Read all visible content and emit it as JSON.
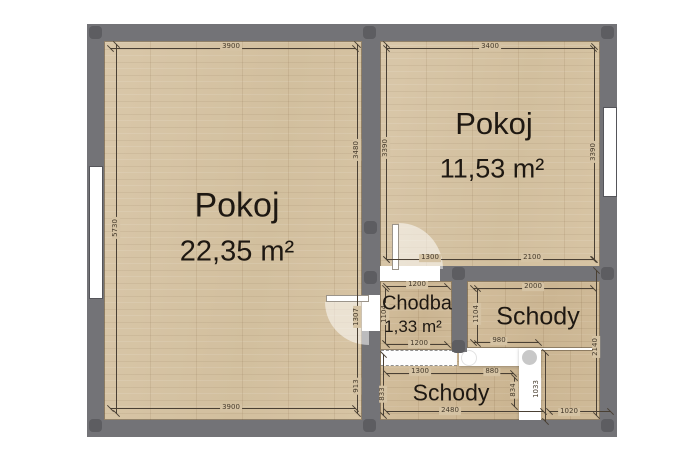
{
  "plan_type": "floor-plan",
  "rooms": [
    {
      "name": "Pokoj",
      "area": "22,35 m²"
    },
    {
      "name": "Pokoj",
      "area": "11,53 m²"
    },
    {
      "name": "Chodba",
      "area": "1,33 m²"
    },
    {
      "name": "Schody",
      "area": ""
    },
    {
      "name": "Schody",
      "area": ""
    }
  ],
  "dims": [
    "3900",
    "5730",
    "3480",
    "1307",
    "913",
    "3900",
    "3400",
    "3390",
    "3390",
    "1300",
    "2100",
    "1200",
    "2000",
    "1104",
    "1104",
    "1200",
    "980",
    "1300",
    "880",
    "833",
    "834",
    "1033",
    "2140",
    "2480",
    "1020"
  ],
  "colors": {
    "wall": "#737377",
    "post": "#5d5d61",
    "floor_light": "#d6c4a5",
    "floor_dark": "#cdb795",
    "dimension_line": "#4a4034",
    "text": "#1e1812",
    "opening_white": "#ffffff"
  }
}
